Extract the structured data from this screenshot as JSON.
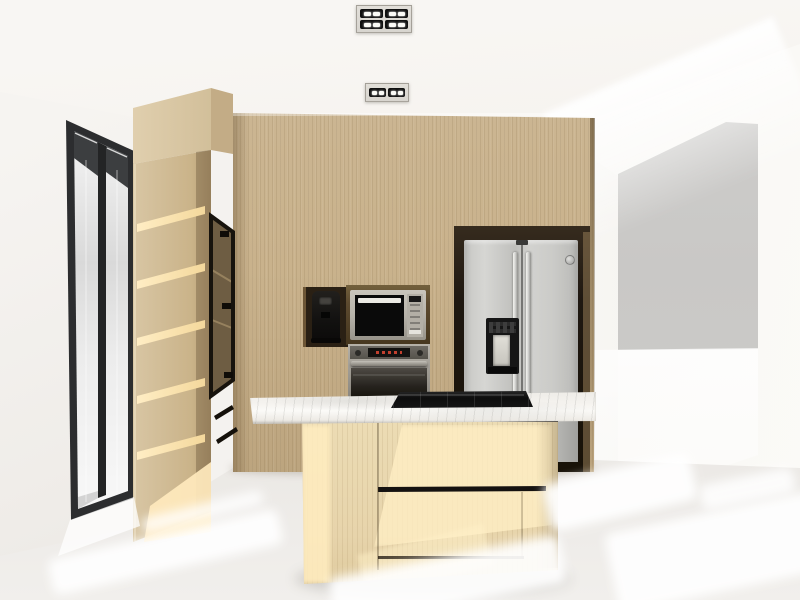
{
  "scene": {
    "title": "Kitchen interior 3D render",
    "description": "Architectural rendering of a kitchen: wood-paneled back wall with built-in coffee machine, microwave and oven, stainless french-handle refrigerator in a niche, island with marble countertop and black gas cooktop, tall open-shelf wood cabinet with black-framed glass door unit, black-framed window on the left, white walls and sunlit white floor, doorway opening on the right, two recessed ceiling light fixtures.",
    "objects": [
      {
        "name": "ceiling-light-fixture-a",
        "description": "recessed fixture with 4 lamp modules"
      },
      {
        "name": "ceiling-light-fixture-b",
        "description": "recessed fixture with 2 lamp modules"
      },
      {
        "name": "window",
        "description": "tall two-panel window with black frame"
      },
      {
        "name": "tall-shelf-cabinet",
        "description": "wood column with 6 open shelves"
      },
      {
        "name": "glass-door-cabinet",
        "description": "black metal framed glass door with 3 hinges"
      },
      {
        "name": "drawer-unit",
        "description": "two drawers with angled black handle grooves"
      },
      {
        "name": "coffee-machine",
        "description": "black built-in coffee machine in dark niche"
      },
      {
        "name": "microwave",
        "description": "built-in stainless microwave with black glass door"
      },
      {
        "name": "oven",
        "description": "built-in wall oven with red display and bar handle"
      },
      {
        "name": "refrigerator",
        "description": "stainless refrigerator with twin handles, water dispenser and round brand badge"
      },
      {
        "name": "kitchen-island",
        "description": "wood base island, black reveal and drawer groove"
      },
      {
        "name": "marble-countertop",
        "description": "white marble slab with overhang"
      },
      {
        "name": "gas-cooktop",
        "description": "black cooktop with 5 grate sections"
      },
      {
        "name": "doorway-opening",
        "description": "opening on right revealing gray wall plane"
      },
      {
        "name": "floor",
        "description": "white floor with diagonal sunlight patches"
      }
    ],
    "counts": {
      "open_shelves": 6,
      "fixture_a_modules": 4,
      "fixture_b_modules": 2,
      "glass_cabinet_hinges": 3,
      "drawer_grooves": 2,
      "cooktop_sections": 5
    }
  },
  "colors": {
    "ceiling_top": "#f8f6f3",
    "ceiling_shade": "#e7e0d4",
    "wall_left": "#efece8",
    "wall_right": "#f3f1ee",
    "wood_back": "#c9b28c",
    "wood_back_dark": "#b49c76",
    "wood_light": "#dccab4",
    "wood_sun": "#ffe9bd",
    "island_wood": "#ecdcb4",
    "marble": "#f4f2ee",
    "frame_black": "#17130d",
    "window_frame": "#2c2d2f",
    "glass": "#e8e8e8",
    "steel": "#c9c9c6",
    "appliance_black": "#0a0a0a",
    "niche_coffee": "#2a2014",
    "niche_micro": "#5d4a2f",
    "niche_fridge": "#1f1811",
    "micro_frame": "#b7b3aa",
    "oven_frame": "#a29e96",
    "oven_door": "#141109",
    "dispenser": "#161616",
    "display_red": "#c2402e",
    "fixture_black": "#101010",
    "led_white": "#fafaf6",
    "plate": "#d8d5cf",
    "gray_plane": "#c9c8c6",
    "floor": "#e6e3df",
    "floor_deep": "#d8d5d1",
    "sun_white": "#ffffff"
  }
}
